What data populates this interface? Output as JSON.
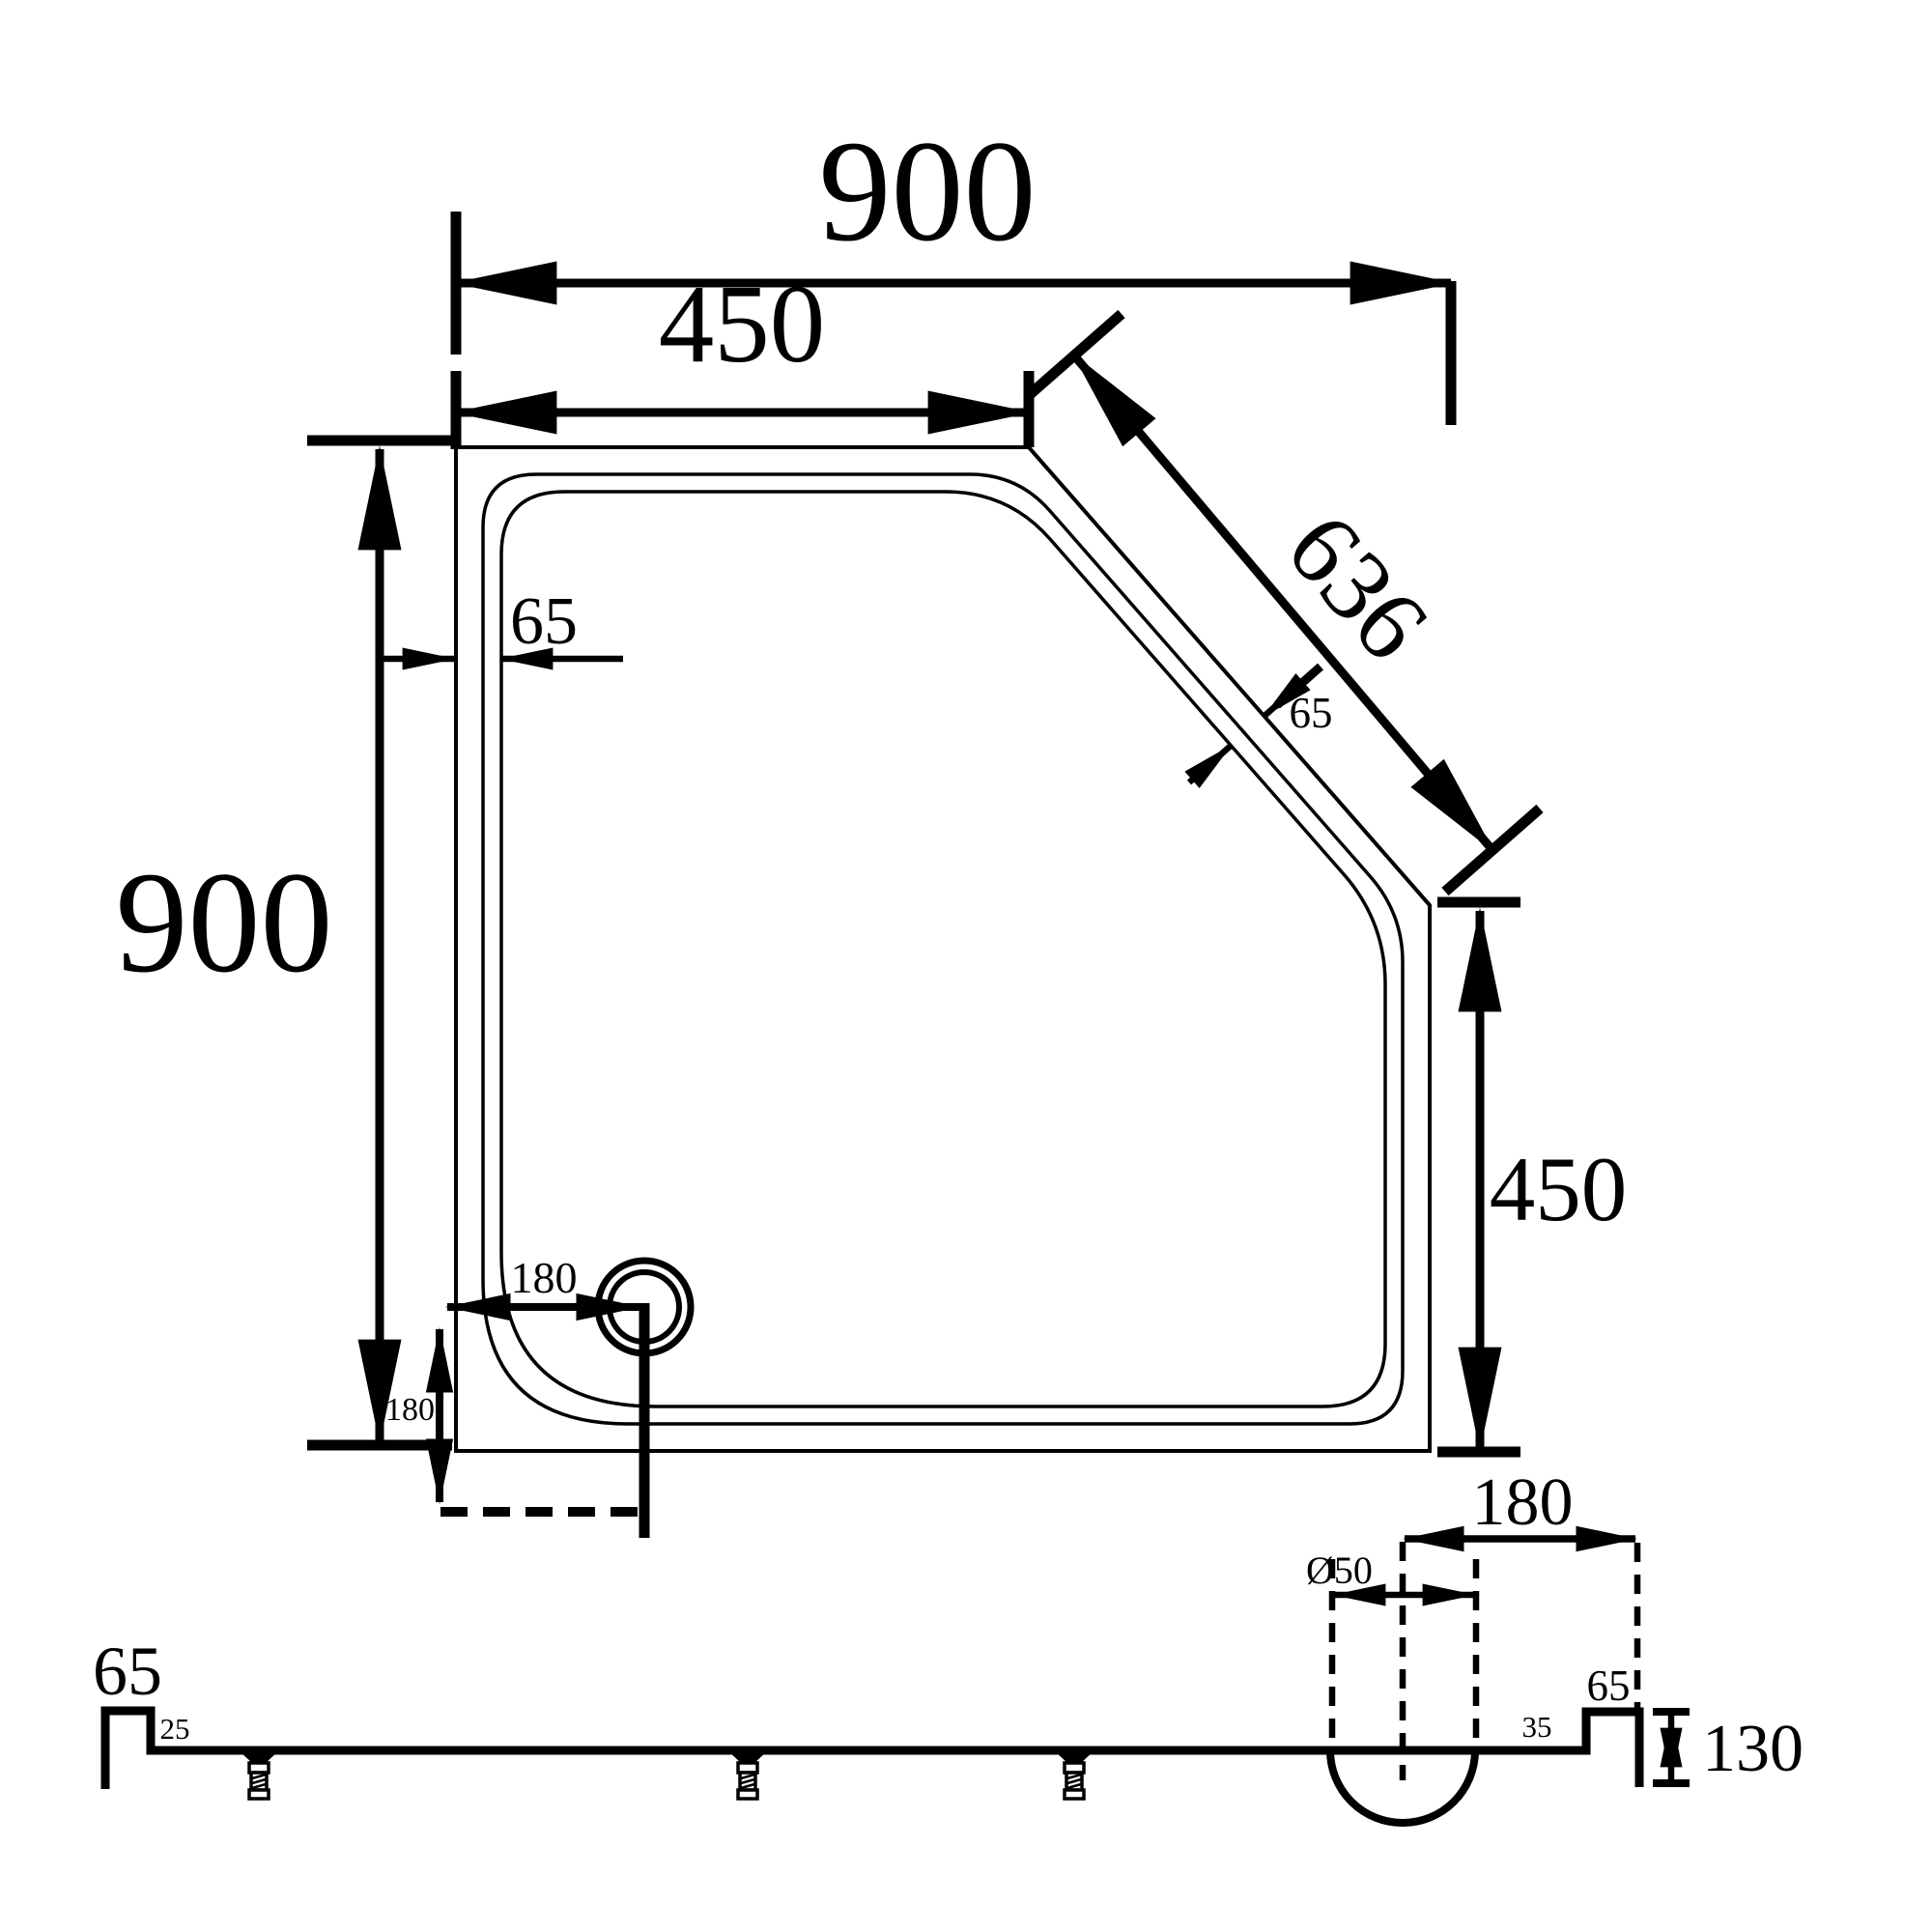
{
  "drawing": {
    "plan": {
      "overall_width": "900",
      "top_edge_half": "450",
      "diagonal_edge": "636",
      "overall_depth": "900",
      "right_edge_half": "450",
      "rim_width": "65",
      "rim_width_diagonal": "65",
      "drain_offset_horizontal": "180",
      "drain_offset_vertical": "180"
    },
    "section": {
      "left_upstand_width": "65",
      "left_upstand_height": "25",
      "waste_diameter": "Ø50",
      "waste_center_to_edge": "180",
      "right_upstand_width": "65",
      "ledge_width": "35",
      "overall_height": "130"
    },
    "colors": {
      "ink": "#000000",
      "paper": "#ffffff"
    }
  }
}
